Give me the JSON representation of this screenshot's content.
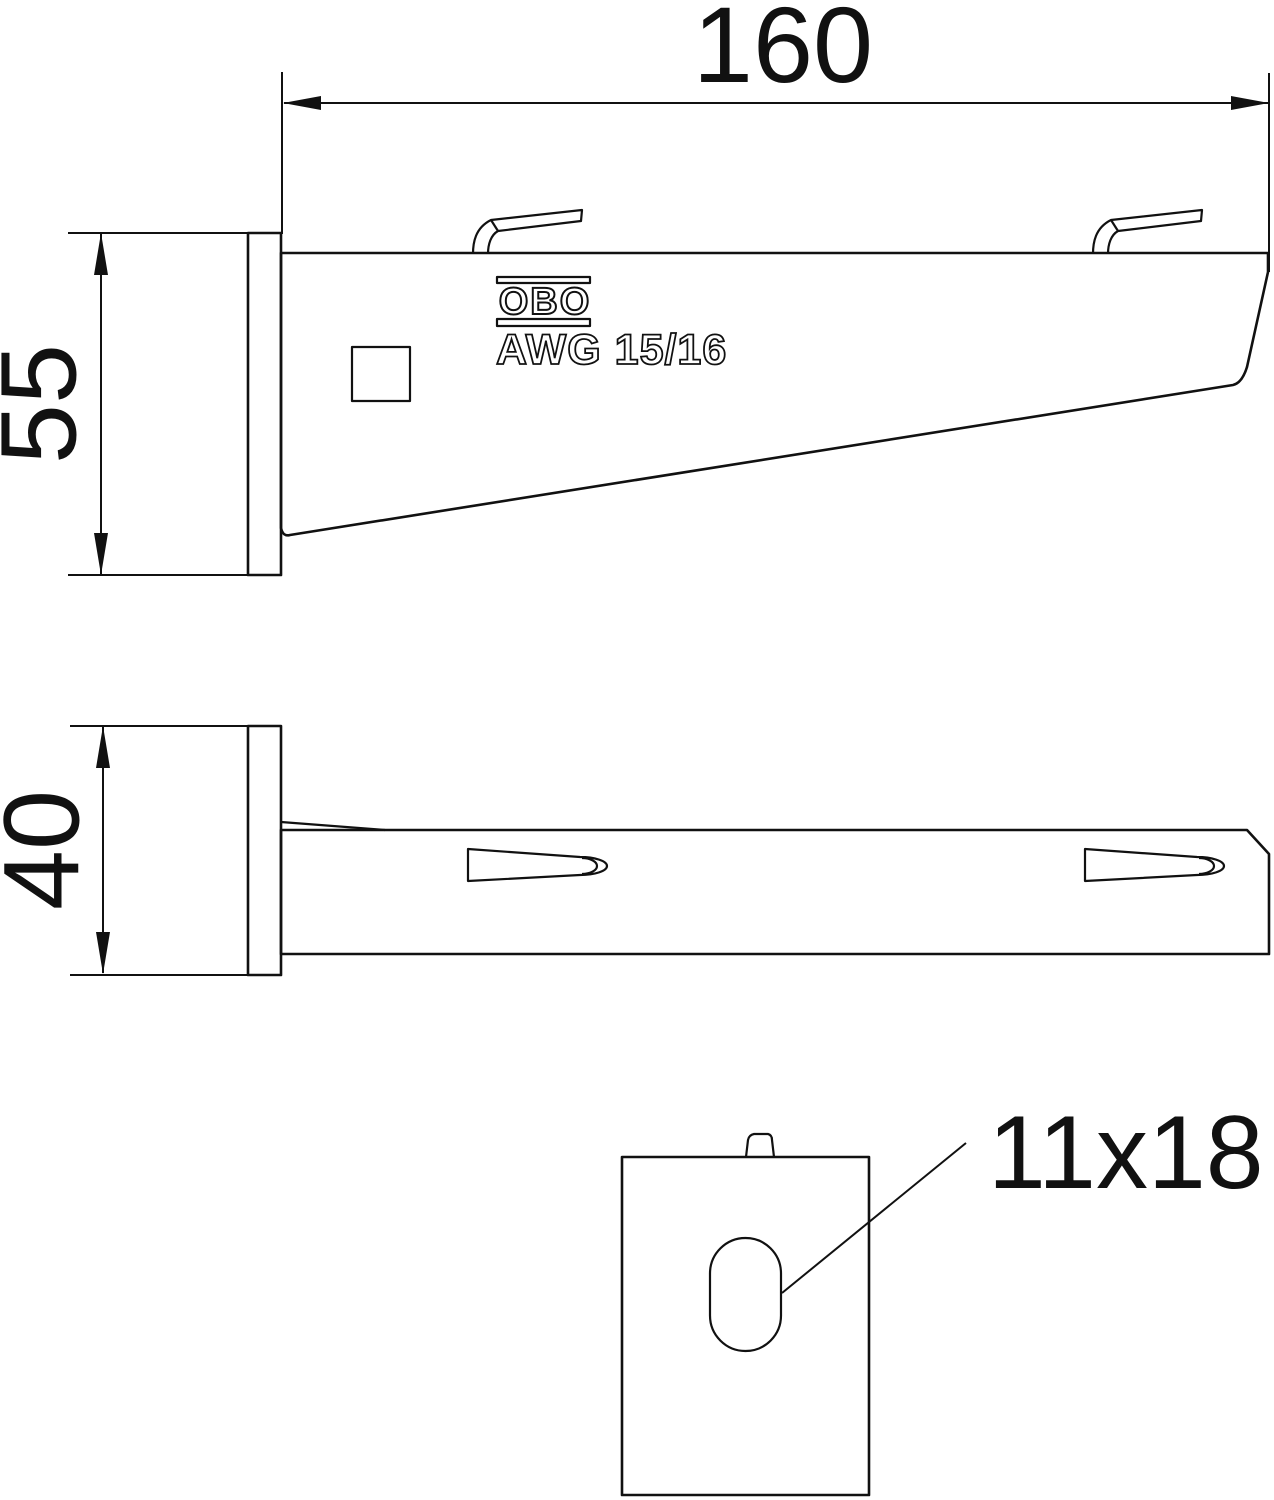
{
  "drawing": {
    "type": "technical-drawing",
    "subject": "wall and support bracket, three orthographic views with detail of mounting slot",
    "colors": {
      "background": "#ffffff",
      "line": "#111111"
    },
    "dimensions": {
      "arm_length": "160",
      "plate_height": "55",
      "plate_width": "40",
      "slot_hole": "11x18"
    },
    "branding": {
      "logo_text": "OBO",
      "model_text": "AWG 15/16"
    }
  }
}
